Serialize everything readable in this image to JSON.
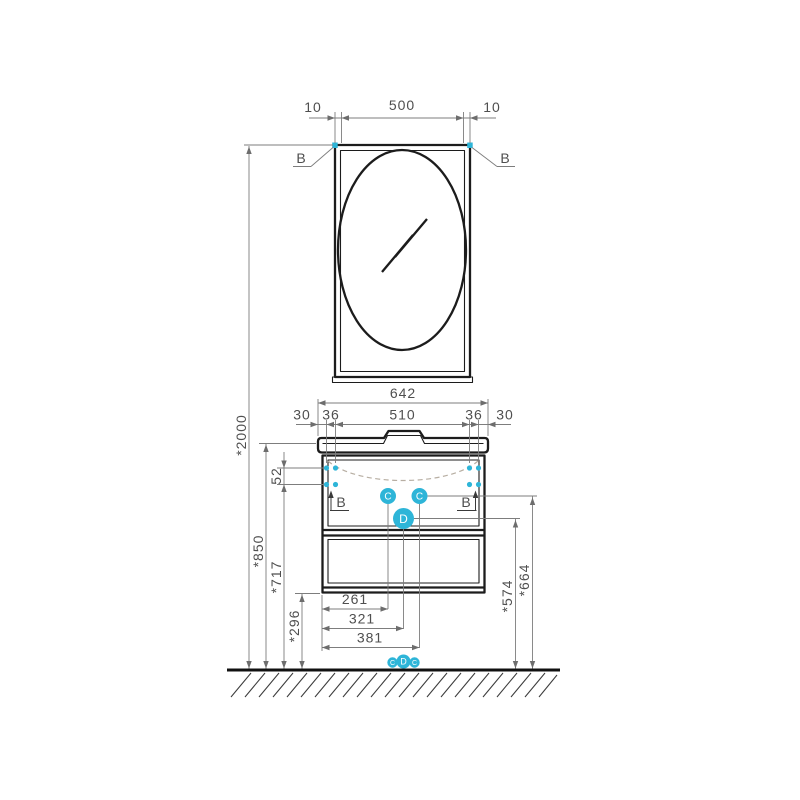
{
  "colors": {
    "accent": "#2eb5d8"
  },
  "mirror": {
    "dim_left": "10",
    "dim_center": "500",
    "dim_right": "10",
    "callout_left": "B",
    "callout_right": "B"
  },
  "cabinet": {
    "dim_width": "642",
    "seg_1": "30",
    "seg_2": "36",
    "seg_3": "510",
    "seg_4": "36",
    "seg_5": "30",
    "callout_left": "B",
    "callout_right": "B",
    "port_c_left": "C",
    "port_c_right": "C",
    "port_d": "D"
  },
  "heights": {
    "total": "*2000",
    "worktop": "*850",
    "hole_spacing": "52",
    "holes": "*717",
    "clearance": "*296",
    "drain": "*574",
    "supply": "*664"
  },
  "offsets": {
    "w1": "261",
    "w2": "321",
    "w3": "381"
  },
  "floor": {
    "port_left": "C",
    "port_center": "D",
    "port_right": "C"
  }
}
